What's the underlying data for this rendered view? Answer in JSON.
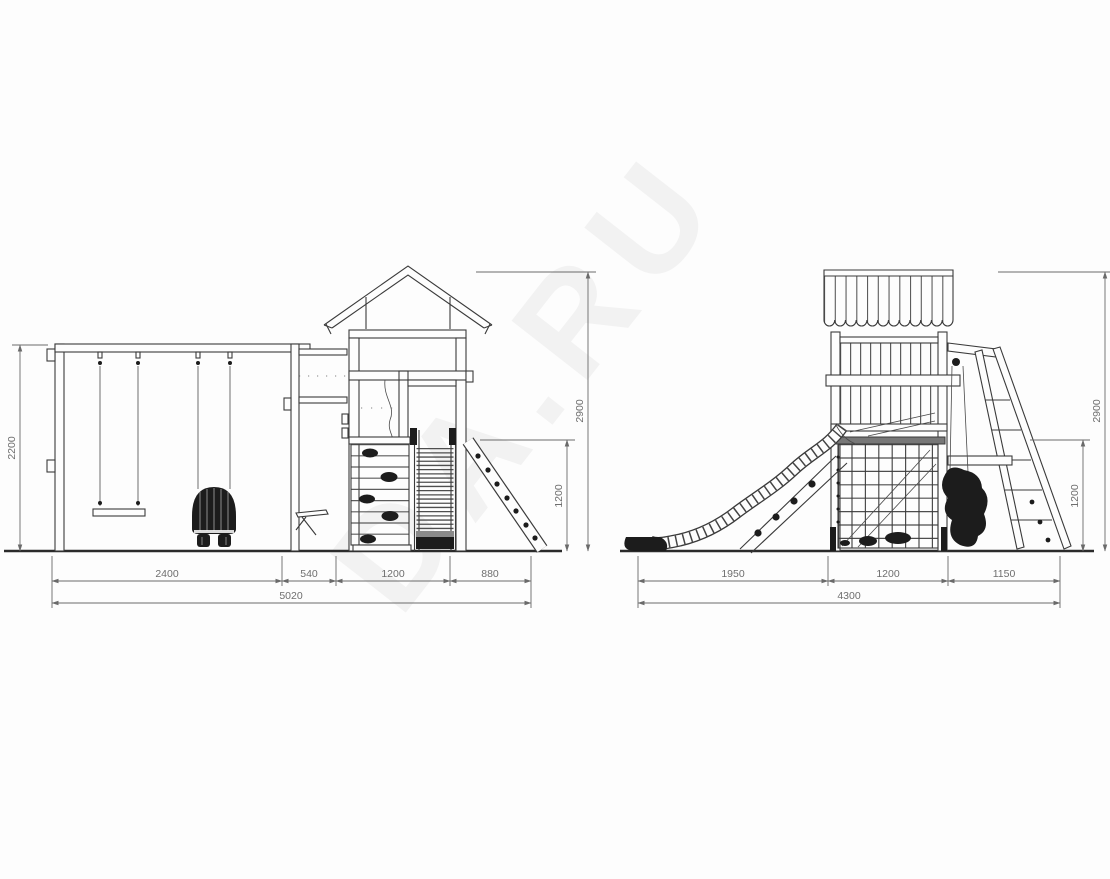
{
  "document": {
    "type": "technical-drawing",
    "subject": "playground-structure-elevations",
    "background_color": "#fdfdfd",
    "line_color": "#3a3a3a",
    "dimension_color": "#6e6e6e"
  },
  "watermark": {
    "text": "DA.RU"
  },
  "front_view": {
    "name": "front-elevation-with-swings",
    "dimensions": {
      "height_frame": "2200",
      "height_total": "2900",
      "height_ladder": "1200",
      "span_swings": "2400",
      "span_porch": "540",
      "span_tower": "1200",
      "span_ladder": "880",
      "span_total": "5020"
    }
  },
  "side_view": {
    "name": "side-elevation-with-slide",
    "dimensions": {
      "height_total": "2900",
      "height_swing": "1200",
      "span_slide": "1950",
      "span_tower": "1200",
      "span_swing": "1150",
      "span_total": "4300"
    }
  }
}
